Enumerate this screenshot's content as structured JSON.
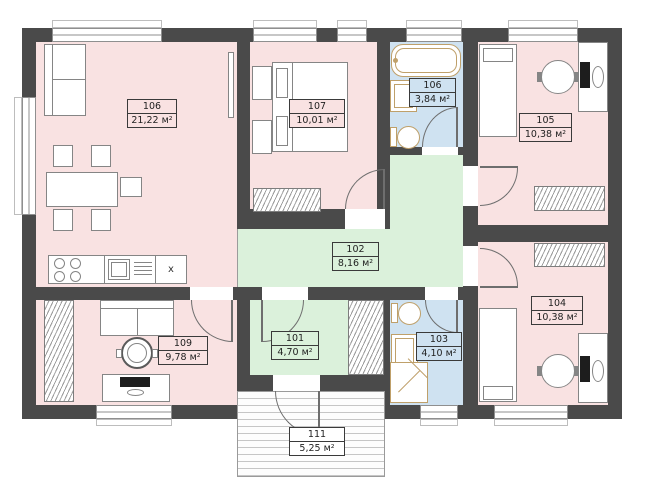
{
  "plan": {
    "rooms": [
      {
        "number": "106",
        "area": "21,22 м²"
      },
      {
        "number": "107",
        "area": "10,01 м²"
      },
      {
        "number": "106",
        "area": "3,84 м²"
      },
      {
        "number": "105",
        "area": "10,38 м²"
      },
      {
        "number": "102",
        "area": "8,16 м²"
      },
      {
        "number": "101",
        "area": "4,70 м²"
      },
      {
        "number": "109",
        "area": "9,78 м²"
      },
      {
        "number": "103",
        "area": "4,10 м²"
      },
      {
        "number": "104",
        "area": "10,38 м²"
      },
      {
        "number": "111",
        "area": "5,25 м²"
      }
    ],
    "kitchen_cabinet_label": "x"
  },
  "colors": {
    "wall": "#4a4a4a",
    "room_pink": "#f9e2e2",
    "room_green": "#dbf1db",
    "room_blue": "#cfe2f1",
    "fixture_outline": "#bfa06a",
    "background": "#ffffff"
  }
}
